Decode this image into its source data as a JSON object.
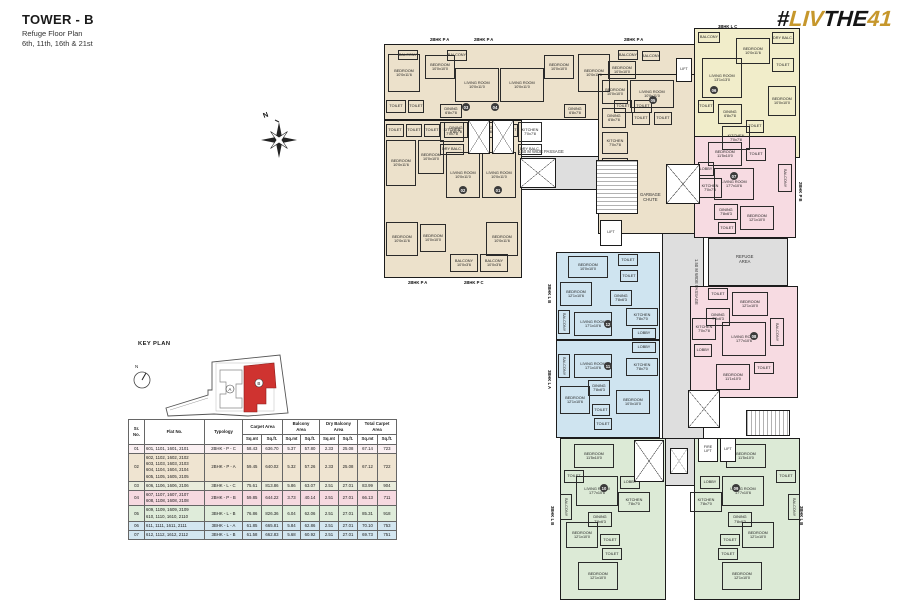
{
  "header": {
    "title": "TOWER - B",
    "subtitle": "Refuge Floor Plan",
    "floors": "6th, 11th, 16th & 21st"
  },
  "logo": {
    "hash": "#",
    "part_liv": "LIV",
    "part_the": "THE",
    "part_41": "41",
    "gold_color": "#c6972c",
    "black_color": "#141414"
  },
  "compass": {
    "north_label": "N"
  },
  "key_plan": {
    "title": "KEY PLAN",
    "tower_a_label": "A",
    "tower_b_label": "B",
    "highlight_color": "#cf3330"
  },
  "table": {
    "col_headers": [
      "Sr. No.",
      "Flat No.",
      "Typology"
    ],
    "group_headers": [
      "Carpet Area",
      "Balcony\nArea",
      "Dry Balcony\nArea",
      "Total Carpet\nArea"
    ],
    "sub_headers": [
      "Sq.mt",
      "Sq.ft."
    ],
    "col_widths": [
      16,
      60,
      38,
      19,
      21,
      18,
      19,
      19,
      19,
      20,
      19
    ],
    "rows": [
      {
        "sr": "01",
        "flats": "601, 1101, 1601, 2101",
        "typology": "2BHK - P - C",
        "values": [
          "58.43",
          "636.70",
          "5.37",
          "57.80",
          "2.33",
          "25.08",
          "67.14",
          "723"
        ],
        "bg": "#faf0f2"
      },
      {
        "sr": "02",
        "flats": "602, 1102, 1602, 2102\n603, 1103, 1603, 2103\n604, 1104, 1604, 2104\n605, 1105, 1605, 2105",
        "typology": "2BHK - P - A",
        "values": [
          "59.45",
          "640.02",
          "5.32",
          "57.26",
          "2.33",
          "25.08",
          "67.12",
          "722"
        ],
        "bg": "#efe4d1"
      },
      {
        "sr": "03",
        "flats": "606, 1106, 1606, 2106",
        "typology": "3BHK - L - C",
        "values": [
          "75.61",
          "813.86",
          "5.86",
          "63.07",
          "2.51",
          "27.01",
          "83.99",
          "904"
        ],
        "bg": "#e9ecdc"
      },
      {
        "sr": "04",
        "flats": "607, 1107, 1607, 2107\n608, 1108, 1608, 2108",
        "typology": "2BHK - P - B",
        "values": [
          "59.85",
          "644.22",
          "3.73",
          "40.14",
          "2.51",
          "27.01",
          "66.13",
          "711"
        ],
        "bg": "#f6d9e0"
      },
      {
        "sr": "05",
        "flats": "609, 1109, 1609, 2109\n610, 1110, 1610, 2110",
        "typology": "3BHK - L - B",
        "values": [
          "76.86",
          "826.36",
          "6.04",
          "62.06",
          "2.51",
          "27.01",
          "85.31",
          "918"
        ],
        "bg": "#dfecda"
      },
      {
        "sr": "06",
        "flats": "611, 1111, 1611, 2111",
        "typology": "3BHK - L - A",
        "values": [
          "61.85",
          "665.81",
          "5.84",
          "62.86",
          "2.51",
          "27.01",
          "70.10",
          "753"
        ],
        "bg": "#d3e6f0"
      },
      {
        "sr": "07",
        "flats": "612, 1112, 1612, 2112",
        "typology": "3BHK - L - B",
        "values": [
          "61.58",
          "662.83",
          "5.68",
          "60.92",
          "2.51",
          "27.01",
          "69.73",
          "751"
        ],
        "bg": "#d3e6f0"
      }
    ]
  },
  "floorplan": {
    "colors": {
      "cream": "#ece1cb",
      "yellow": "#f1edca",
      "pink": "#f7dbe2",
      "blue": "#cfe4f0",
      "green": "#dcead6",
      "gray": "#dedede",
      "wall": "#1c1c1c"
    },
    "blocks": [
      [
        44,
        132,
        282,
        34,
        "gray"
      ],
      [
        284,
        132,
        42,
        330,
        "gray"
      ],
      [
        252,
        414,
        66,
        48,
        "gray"
      ],
      [
        6,
        20,
        312,
        76,
        "cream"
      ],
      [
        6,
        96,
        138,
        158,
        "cream"
      ],
      [
        220,
        50,
        98,
        160,
        "cream"
      ],
      [
        316,
        4,
        106,
        130,
        "yellow"
      ],
      [
        316,
        112,
        102,
        102,
        "pink"
      ],
      [
        330,
        214,
        80,
        48,
        "gray"
      ],
      [
        312,
        262,
        108,
        112,
        "pink"
      ],
      [
        178,
        228,
        104,
        88,
        "blue"
      ],
      [
        178,
        316,
        104,
        98,
        "blue"
      ],
      [
        182,
        414,
        106,
        162,
        "green"
      ],
      [
        316,
        414,
        106,
        162,
        "green"
      ]
    ],
    "rooms": [
      [
        20,
        26,
        20,
        10,
        "BALCONY"
      ],
      [
        10,
        30,
        32,
        38,
        "BEDROOM\n10'0x11'6"
      ],
      [
        47,
        31,
        30,
        24,
        "BEDROOM\n10'0x10'0"
      ],
      [
        8,
        76,
        20,
        13,
        "TOILET"
      ],
      [
        30,
        76,
        16,
        13,
        "TOILET"
      ],
      [
        69,
        26,
        20,
        11,
        "BALCONY"
      ],
      [
        77,
        44,
        44,
        34,
        "LIVING ROOM\n10'0x11'0"
      ],
      [
        62,
        80,
        22,
        14,
        "DINING\n6'8x7'8"
      ],
      [
        122,
        44,
        44,
        34,
        "LIVING ROOM\n10'0x11'0"
      ],
      [
        166,
        31,
        30,
        24,
        "BEDROOM\n10'0x10'0"
      ],
      [
        200,
        30,
        32,
        38,
        "BEDROOM\n10'0x11'6"
      ],
      [
        186,
        80,
        22,
        14,
        "DINING\n6'8x7'8"
      ],
      [
        236,
        76,
        18,
        13,
        "TOILET"
      ],
      [
        256,
        76,
        18,
        13,
        "TOILET"
      ],
      [
        240,
        26,
        20,
        10,
        "BALCONY"
      ],
      [
        264,
        27,
        18,
        10,
        "BALCONY"
      ],
      [
        230,
        37,
        28,
        18,
        "BEDROOM\n10'0x10'0"
      ],
      [
        62,
        98,
        24,
        20,
        "KITCHEN\n7'0x7'8"
      ],
      [
        62,
        120,
        24,
        11,
        "DRY BALC."
      ],
      [
        140,
        98,
        24,
        20,
        "KITCHEN\n7'0x7'8"
      ],
      [
        140,
        120,
        24,
        11,
        "DRY BALC."
      ],
      [
        224,
        56,
        26,
        24,
        "BEDROOM\n10'0x10'0"
      ],
      [
        252,
        56,
        44,
        28,
        "LIVING ROOM\n10'0x11'0"
      ],
      [
        224,
        84,
        24,
        20,
        "DINING\n6'8x7'8"
      ],
      [
        254,
        88,
        18,
        13,
        "TOILET"
      ],
      [
        276,
        88,
        18,
        13,
        "TOILET"
      ],
      [
        224,
        108,
        26,
        22,
        "KITCHEN\n7'0x7'8"
      ],
      [
        224,
        134,
        26,
        12,
        "DRY BALC."
      ],
      [
        8,
        100,
        18,
        13,
        "TOILET"
      ],
      [
        28,
        100,
        16,
        13,
        "TOILET"
      ],
      [
        46,
        100,
        16,
        13,
        "TOILET"
      ],
      [
        66,
        98,
        24,
        16,
        "DINING\n6'8x7'8"
      ],
      [
        96,
        98,
        24,
        16,
        "DINING\n6'8x7'8"
      ],
      [
        124,
        100,
        16,
        13,
        "TOILET"
      ],
      [
        8,
        116,
        30,
        46,
        "BEDROOM\n10'0x11'6"
      ],
      [
        40,
        116,
        26,
        34,
        "BEDROOM\n10'0x10'0"
      ],
      [
        68,
        128,
        34,
        46,
        "LIVING ROOM\n10'0x11'0"
      ],
      [
        104,
        128,
        34,
        46,
        "LIVING ROOM\n10'0x11'0"
      ],
      [
        8,
        198,
        32,
        34,
        "BEDROOM\n10'0x11'6"
      ],
      [
        42,
        200,
        26,
        28,
        "BEDROOM\n10'0x10'0"
      ],
      [
        108,
        198,
        32,
        34,
        "BEDROOM\n10'0x11'6"
      ],
      [
        72,
        230,
        28,
        18,
        "BALCONY\n10'0x3'6"
      ],
      [
        102,
        230,
        28,
        18,
        "BALCONY\n10'0x3'6"
      ],
      [
        320,
        8,
        22,
        11,
        "BALCONY"
      ],
      [
        358,
        14,
        34,
        26,
        "BEDROOM\n10'0x11'6"
      ],
      [
        394,
        8,
        22,
        12,
        "DRY BALC."
      ],
      [
        394,
        34,
        22,
        14,
        "TOILET"
      ],
      [
        324,
        34,
        40,
        40,
        "LIVING ROOM\n13'1x13'0"
      ],
      [
        320,
        76,
        16,
        13,
        "TOILET"
      ],
      [
        340,
        80,
        24,
        20,
        "DINING\n6'8x7'8"
      ],
      [
        390,
        62,
        28,
        30,
        "BEDROOM\n10'0x10'0"
      ],
      [
        368,
        96,
        18,
        13,
        "TOILET"
      ],
      [
        344,
        102,
        28,
        24,
        "KITCHEN\n7'0x7'8"
      ],
      [
        330,
        118,
        34,
        24,
        "BEDROOM\n11'5x10'0"
      ],
      [
        368,
        124,
        20,
        13,
        "TOILET"
      ],
      [
        320,
        138,
        16,
        14,
        "LOBBY"
      ],
      [
        336,
        144,
        40,
        32,
        "LIVING ROOM\n17'7x10'6"
      ],
      [
        400,
        140,
        14,
        28,
        "BALCONY",
        90
      ],
      [
        320,
        154,
        24,
        20,
        "KITCHEN\n7'0x7'8"
      ],
      [
        336,
        180,
        24,
        16,
        "DINING\n7'8x6'3"
      ],
      [
        362,
        182,
        34,
        24,
        "BEDROOM\n12'1x10'0"
      ],
      [
        340,
        198,
        18,
        12,
        "TOILET"
      ],
      [
        330,
        264,
        20,
        12,
        "TOILET"
      ],
      [
        354,
        268,
        36,
        24,
        "BEDROOM\n12'1x10'0"
      ],
      [
        328,
        284,
        24,
        18,
        "DINING\n7'8x6'3"
      ],
      [
        314,
        294,
        24,
        22,
        "KITCHEN\n7'0x7'8"
      ],
      [
        316,
        320,
        18,
        13,
        "LOBBY"
      ],
      [
        344,
        298,
        44,
        34,
        "LIVING ROOM\n17'7x10'6"
      ],
      [
        392,
        294,
        14,
        28,
        "BALCONY",
        90
      ],
      [
        338,
        340,
        34,
        26,
        "BEDROOM\n11'1x10'0"
      ],
      [
        376,
        338,
        20,
        12,
        "TOILET"
      ],
      [
        190,
        232,
        40,
        22,
        "BEDROOM\n10'0x10'0"
      ],
      [
        240,
        230,
        20,
        12,
        "TOILET"
      ],
      [
        242,
        246,
        18,
        12,
        "TOILET"
      ],
      [
        182,
        258,
        32,
        24,
        "BEDROOM\n12'1x10'6"
      ],
      [
        180,
        286,
        12,
        24,
        "BALCONY",
        90
      ],
      [
        232,
        266,
        22,
        16,
        "DINING\n7'8x6'3"
      ],
      [
        248,
        284,
        32,
        18,
        "KITCHEN\n7'8x7'0"
      ],
      [
        196,
        288,
        38,
        24,
        "LIVING ROOM\n17'1x10'6"
      ],
      [
        254,
        304,
        24,
        11,
        "LOBBY"
      ],
      [
        180,
        330,
        12,
        24,
        "BALCONY",
        90
      ],
      [
        254,
        318,
        24,
        11,
        "LOBBY"
      ],
      [
        196,
        330,
        38,
        24,
        "LIVING ROOM\n17'1x10'6"
      ],
      [
        248,
        334,
        32,
        18,
        "KITCHEN\n7'8x7'0"
      ],
      [
        210,
        356,
        22,
        16,
        "DINING\n7'8x6'3"
      ],
      [
        182,
        362,
        30,
        28,
        "BEDROOM\n12'1x10'6"
      ],
      [
        214,
        380,
        18,
        12,
        "TOILET"
      ],
      [
        216,
        394,
        18,
        12,
        "TOILET"
      ],
      [
        238,
        366,
        34,
        24,
        "BEDROOM\n10'0x10'0"
      ],
      [
        196,
        420,
        40,
        24,
        "BEDROOM\n11'5x10'0"
      ],
      [
        186,
        446,
        20,
        13,
        "TOILET"
      ],
      [
        182,
        470,
        12,
        26,
        "BALCONY",
        90
      ],
      [
        198,
        452,
        42,
        30,
        "LIVING ROOM\n17'7x10'6"
      ],
      [
        242,
        452,
        20,
        13,
        "LOBBY"
      ],
      [
        240,
        468,
        32,
        20,
        "KITCHEN\n7'8x7'0"
      ],
      [
        210,
        488,
        24,
        15,
        "DINING\n7'8x6'3"
      ],
      [
        188,
        498,
        32,
        26,
        "BEDROOM\n12'1x10'0"
      ],
      [
        222,
        510,
        20,
        12,
        "TOILET"
      ],
      [
        224,
        524,
        20,
        12,
        "TOILET"
      ],
      [
        200,
        538,
        40,
        28,
        "BEDROOM\n12'1x10'0"
      ],
      [
        348,
        420,
        40,
        24,
        "BEDROOM\n11'5x10'0"
      ],
      [
        398,
        446,
        20,
        13,
        "TOILET"
      ],
      [
        410,
        470,
        12,
        26,
        "BALCONY",
        90
      ],
      [
        344,
        452,
        42,
        30,
        "LIVING ROOM\n17'7x10'6"
      ],
      [
        322,
        452,
        20,
        13,
        "LOBBY"
      ],
      [
        312,
        468,
        32,
        20,
        "KITCHEN\n7'8x7'0"
      ],
      [
        350,
        488,
        24,
        15,
        "DINING\n7'8x6'3"
      ],
      [
        364,
        498,
        32,
        26,
        "BEDROOM\n12'1x10'0"
      ],
      [
        342,
        510,
        20,
        12,
        "TOILET"
      ],
      [
        340,
        524,
        20,
        12,
        "TOILET"
      ],
      [
        344,
        538,
        40,
        28,
        "BEDROOM\n12'1x10'0"
      ]
    ],
    "shafts": [
      [
        90,
        96,
        22,
        34,
        "xbox"
      ],
      [
        114,
        96,
        22,
        34,
        "xbox"
      ],
      [
        142,
        134,
        36,
        30,
        "xbox"
      ],
      [
        218,
        136,
        42,
        54,
        "stairs-h"
      ],
      [
        288,
        140,
        34,
        40,
        "xbox"
      ],
      [
        310,
        366,
        32,
        38,
        "xbox"
      ],
      [
        256,
        416,
        30,
        42,
        "xbox"
      ],
      [
        292,
        424,
        18,
        26,
        "xbox"
      ],
      [
        368,
        386,
        44,
        26,
        "stairs-v"
      ]
    ],
    "lifts": [
      [
        222,
        196,
        22,
        26,
        "LIFT"
      ],
      [
        298,
        34,
        16,
        24,
        "LIFT"
      ],
      [
        320,
        414,
        20,
        24,
        "FIRE\nLIFT"
      ],
      [
        342,
        414,
        16,
        24,
        "LIFT"
      ]
    ],
    "badges": [
      {
        "id": "01",
        "x": 120,
        "y": 166
      },
      {
        "id": "02",
        "x": 85,
        "y": 166
      },
      {
        "id": "03",
        "x": 88,
        "y": 83
      },
      {
        "id": "04",
        "x": 117,
        "y": 83
      },
      {
        "id": "05",
        "x": 275,
        "y": 76
      },
      {
        "id": "06",
        "x": 336,
        "y": 66
      },
      {
        "id": "07",
        "x": 356,
        "y": 152
      },
      {
        "id": "08",
        "x": 376,
        "y": 312
      },
      {
        "id": "09",
        "x": 358,
        "y": 464
      },
      {
        "id": "10",
        "x": 226,
        "y": 464
      },
      {
        "id": "11",
        "x": 230,
        "y": 342
      },
      {
        "id": "12",
        "x": 230,
        "y": 300
      }
    ],
    "texts": [
      {
        "t": "2BHK P A",
        "x": 52,
        "y": 13
      },
      {
        "t": "2BHK P A",
        "x": 96,
        "y": 13
      },
      {
        "t": "2BHK P A",
        "x": 246,
        "y": 13
      },
      {
        "t": "3BHK L C",
        "x": 340,
        "y": 0
      },
      {
        "t": "2BHK P A",
        "x": 30,
        "y": 256
      },
      {
        "t": "2BHK P C",
        "x": 86,
        "y": 256
      },
      {
        "t": "2BHK P B",
        "x": 420,
        "y": 158,
        "rot": 90
      },
      {
        "t": "3BHK L B",
        "x": 169,
        "y": 260,
        "rot": 90
      },
      {
        "t": "3BHK L A",
        "x": 169,
        "y": 346,
        "rot": 90
      },
      {
        "t": "3BHK L B",
        "x": 172,
        "y": 482,
        "rot": 90
      },
      {
        "t": "3BHK L B",
        "x": 421,
        "y": 482,
        "rot": 90
      },
      {
        "t": "1.50 M WIDE PASSAGE",
        "x": 140,
        "y": 125,
        "plain": true
      },
      {
        "t": "1.50 M WIDE PASSAGE",
        "x": 316,
        "y": 235,
        "rot": 90,
        "plain": true
      },
      {
        "t": "GARBAGE\nCHUTE",
        "x": 262,
        "y": 168,
        "plain": true
      },
      {
        "t": "REFUGE\nAREA",
        "x": 358,
        "y": 230,
        "plain": true
      }
    ]
  }
}
